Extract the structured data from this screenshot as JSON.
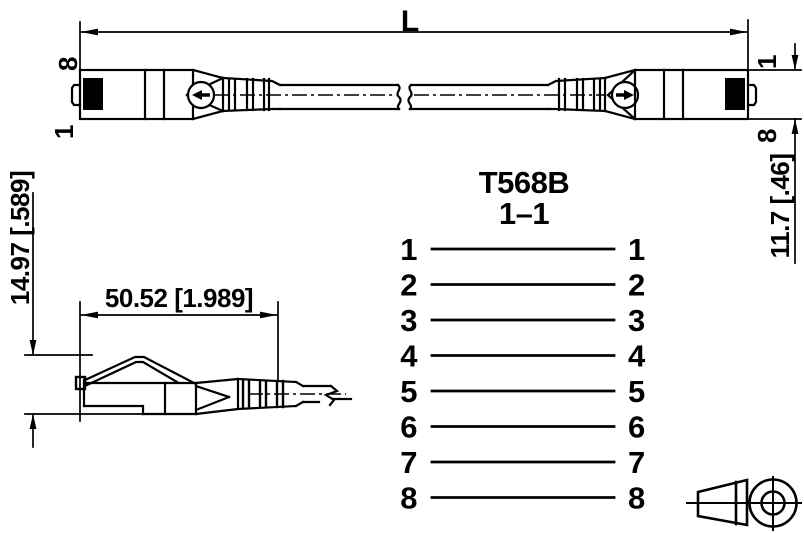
{
  "colors": {
    "line": "#000000",
    "background": "#ffffff"
  },
  "top_view": {
    "length_label": "L",
    "left_end": {
      "top_pin": "8",
      "bottom_pin": "1"
    },
    "right_end": {
      "top_pin": "1",
      "bottom_pin": "8"
    },
    "height_dim": "11.7 [.46]"
  },
  "side_view": {
    "width_dim": "50.52 [1.989]",
    "height_dim": "14.97 [.589]"
  },
  "wiring_diagram": {
    "standard": "T568B",
    "mapping": "1–1",
    "left_pins": [
      "1",
      "2",
      "3",
      "4",
      "5",
      "6",
      "7",
      "8"
    ],
    "right_pins": [
      "1",
      "2",
      "3",
      "4",
      "5",
      "6",
      "7",
      "8"
    ]
  }
}
